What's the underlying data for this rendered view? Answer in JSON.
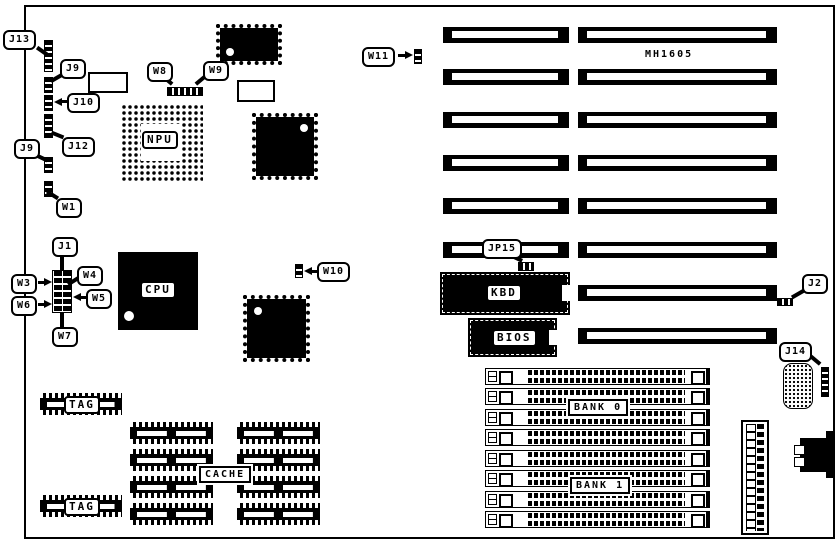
{
  "diagram": {
    "part_number": "MH1605",
    "colors": {
      "ink": "#000000",
      "paper": "#ffffff"
    },
    "callouts": {
      "j13": "J13",
      "j9_top": "J9",
      "j10": "J10",
      "j12": "J12",
      "j9_left": "J9",
      "w1": "W1",
      "w8": "W8",
      "w9": "W9",
      "w11": "W11",
      "w10": "W10",
      "j1": "J1",
      "w3": "W3",
      "w4": "W4",
      "w5": "W5",
      "w6": "W6",
      "w7": "W7",
      "jp15": "JP15",
      "j2": "J2",
      "j14": "J14"
    },
    "chips": {
      "npu": "NPU",
      "cpu": "CPU",
      "kbd": "KBD",
      "bios": "BIOS",
      "cache": "CACHE",
      "tag_top": "TAG",
      "tag_bottom": "TAG",
      "bank0": "BANK 0",
      "bank1": "BANK 1"
    }
  }
}
